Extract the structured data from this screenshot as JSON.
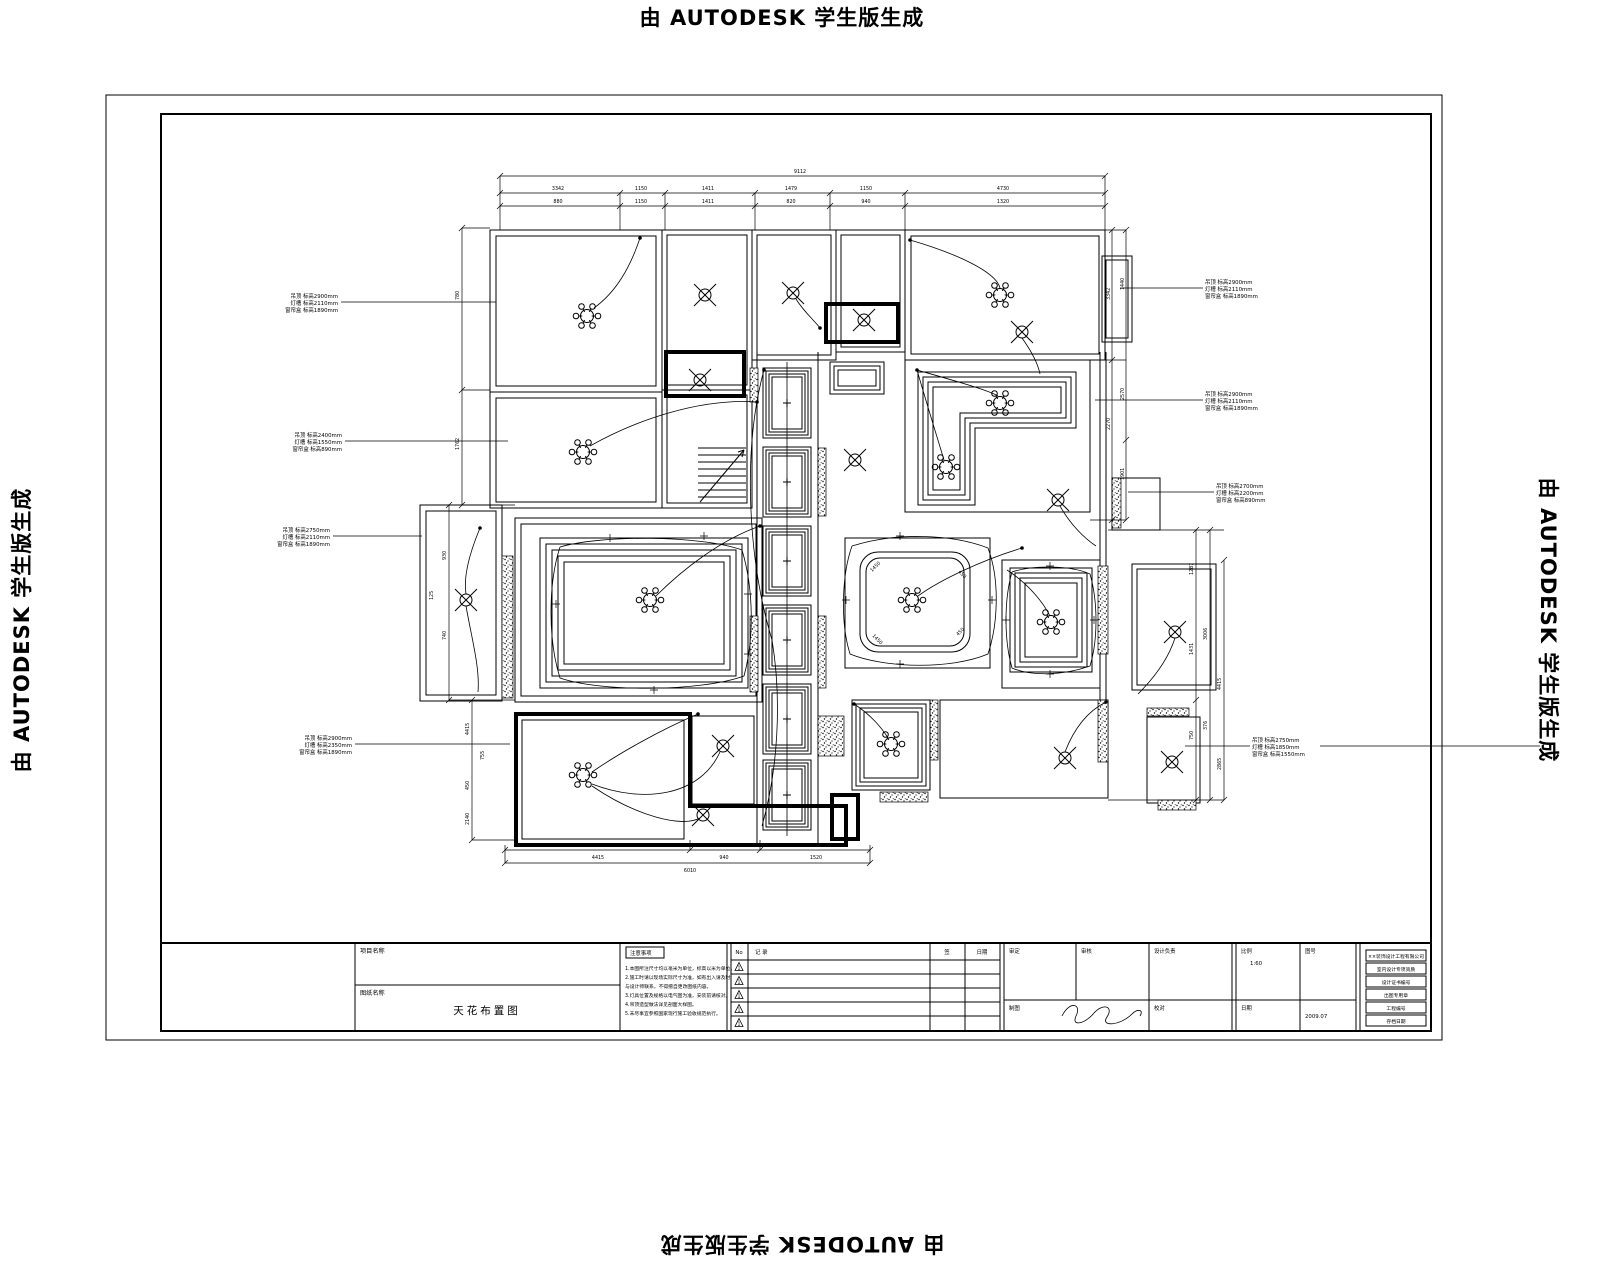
{
  "watermark": {
    "text": "由 AUTODESK 学生版生成"
  },
  "drawing": {
    "callouts": [
      {
        "lines": [
          "吊顶 标高2900mm",
          "灯槽 标高2110mm",
          "窗帘盒 标高1890mm"
        ]
      },
      {
        "lines": [
          "吊顶 标高2400mm",
          "灯槽 标高1550mm",
          "窗帘盒 标高890mm"
        ]
      },
      {
        "lines": [
          "吊顶 标高2750mm",
          "灯槽 标高2110mm",
          "窗帘盒 标高1890mm"
        ]
      },
      {
        "lines": [
          "吊顶 标高2900mm",
          "灯槽 标高2350mm",
          "窗帘盒 标高1890mm"
        ]
      },
      {
        "lines": [
          "吊顶 标高2900mm",
          "灯槽 标高2110mm",
          "窗帘盒 标高1890mm"
        ]
      },
      {
        "lines": [
          "吊顶 标高2900mm",
          "灯槽 标高2110mm",
          "窗帘盒 标高1890mm"
        ]
      },
      {
        "lines": [
          "吊顶 标高2700mm",
          "灯槽 标高2200mm",
          "窗帘盒 标高890mm"
        ]
      },
      {
        "lines": [
          "吊顶 标高2750mm",
          "灯槽 标高1850mm",
          "窗帘盒 标高1550mm"
        ]
      }
    ],
    "dims": {
      "top_overall": "9112",
      "top_row1": [
        "3342",
        "1150",
        "1411",
        "1479",
        "1150",
        "4730"
      ],
      "top_row2": [
        "880",
        "1150",
        "1411",
        "820",
        "940",
        "1320"
      ],
      "left": [
        "780",
        "1762",
        "930",
        "740",
        "125",
        "4415",
        "450",
        "2140",
        "755"
      ],
      "right": [
        "3342",
        "2270",
        "1440",
        "2570",
        "1901",
        "1287",
        "1431",
        "750",
        "3006",
        "376",
        "4415",
        "2865"
      ],
      "bottom": [
        "4415",
        "940",
        "1520",
        "6010"
      ],
      "diag": [
        "1450",
        "450",
        "1450",
        "450"
      ]
    }
  },
  "titleblock": {
    "project_label": "项目名称",
    "drawing_label": "图纸名称",
    "drawing_title": "天花布置图",
    "notes_label": "注意事项",
    "notes_lines": [
      "1.本图所注尺寸均以毫米为单位，标高以米为单位。",
      "2.施工时请以现场实际尺寸为准，如有出入请及时",
      "  与设计师联系，不得擅自更改图纸内容。",
      "3.灯具位置及规格以电气图为准，安装前请核对。",
      "4.吊顶造型做法详见剖面大样图。",
      "5.未尽事宜参照国家现行施工验收规范执行。"
    ],
    "revision": {
      "no": "No",
      "desc": "记 录",
      "sign": "签",
      "date": "日期"
    },
    "sign_row1": [
      "审定",
      "审核",
      "设计负责",
      "比例",
      "图号"
    ],
    "sign_row2": [
      "制图",
      "校对",
      "日期"
    ],
    "values": {
      "scale": "1:60",
      "date": "2009.07"
    },
    "stamps": [
      "××装饰设计工程有限公司",
      "室内设计专项资质",
      "设计证书编号",
      "出图专用章",
      "工程编号",
      "存档日期"
    ]
  }
}
